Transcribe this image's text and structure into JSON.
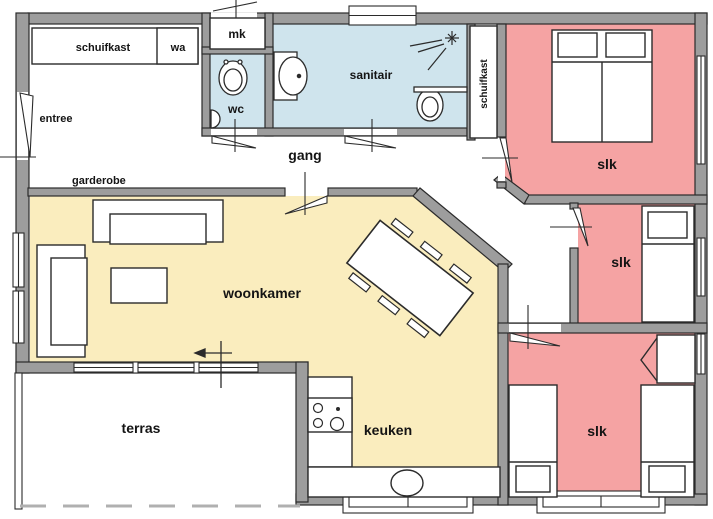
{
  "plan": {
    "type": "floor-plan",
    "language": "nl",
    "colors": {
      "bedroom": "#f5a3a3",
      "bathroom": "#cfe4ed",
      "living": "#faedbe",
      "wall": "#9d9d9d",
      "outline": "#2b2b2b",
      "label": "#141414",
      "dash": "#b0b0b0",
      "floor": "#ffffff"
    },
    "rooms": {
      "closet_top": "schuifkast",
      "wa": "wa",
      "mk": "mk",
      "wc": "wc",
      "sanitair": "sanitair",
      "closet_right": "schuifkast",
      "entree": "entree",
      "gang": "gang",
      "garderobe": "garderobe",
      "woonkamer": "woonkamer",
      "keuken": "keuken",
      "terras": "terras",
      "slk_top": "slk",
      "slk_mid": "slk",
      "slk_bottom": "slk"
    }
  }
}
